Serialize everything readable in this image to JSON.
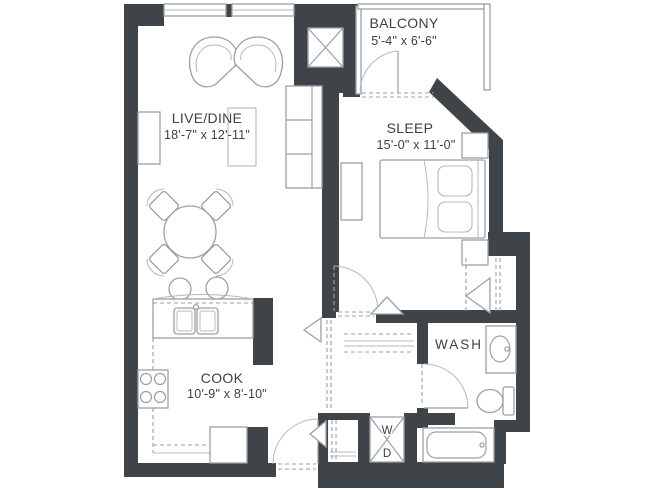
{
  "page": {
    "background": "#ffffff"
  },
  "palette": {
    "wall": "#3f4449",
    "fixture_line": "#9aa0a5",
    "text": "#3d4044"
  },
  "rooms": {
    "balcony": {
      "name": "BALCONY",
      "dims": "5'-4\" x 6'-6\""
    },
    "live_dine": {
      "name": "LIVE/DINE",
      "dims": "18'-7\" x 12'-11\""
    },
    "sleep": {
      "name": "SLEEP",
      "dims": "15'-0\" x 11'-0\""
    },
    "cook": {
      "name": "COOK",
      "dims": "10'-9\" x 8'-10\""
    },
    "wash": {
      "name": "WASH"
    },
    "laundry": {
      "washer": "W",
      "dryer": "D"
    }
  }
}
